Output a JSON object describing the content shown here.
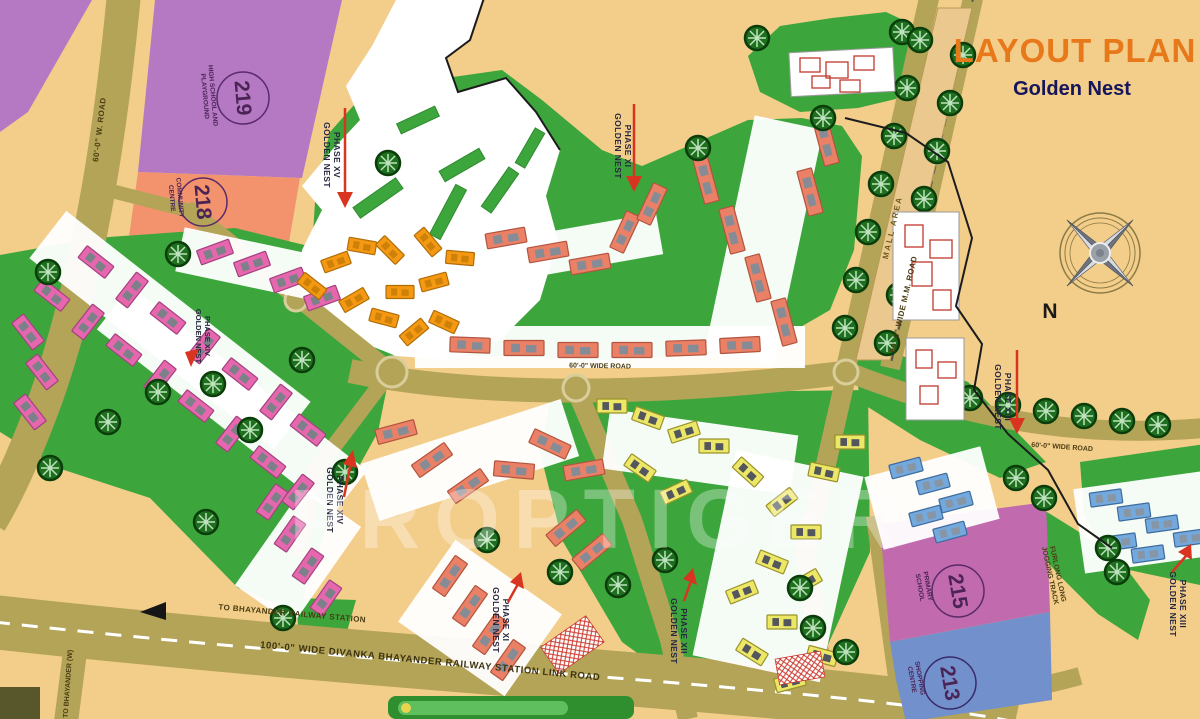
{
  "title": {
    "main": "LAYOUT PLAN",
    "subtitle": "Golden Nest"
  },
  "compass": {
    "north_label": "N"
  },
  "watermark": "PROPTIGER",
  "parcels": [
    {
      "number": "219",
      "label_line1": "HIGH SCHOOL AND",
      "label_line2": "PLAYGROUND"
    },
    {
      "number": "218",
      "label_line1": "COMMUNITY",
      "label_line2": "CENTRE"
    },
    {
      "number": "215",
      "label_line1": "PRIMARY",
      "label_line2": "SCHOOL"
    },
    {
      "number": "213",
      "label_line1": "SHOPPING",
      "label_line2": "CENTRE"
    }
  ],
  "phase_markers": [
    {
      "name": "GOLDEN NEST",
      "phase": "PHASE XV"
    },
    {
      "name": "GOLDEN NEST",
      "phase": "PHASE XI"
    },
    {
      "name": "GOLDEN NEST",
      "phase": "PHASE XIII"
    },
    {
      "name": "GOLDEN NEST",
      "phase": "PHASE XIV"
    },
    {
      "name": "GOLDEN NEST",
      "phase": "PHASE XIV"
    },
    {
      "name": "GOLDEN NEST",
      "phase": "PHASE XI"
    },
    {
      "name": "GOLDEN NEST",
      "phase": "PHASE XII"
    },
    {
      "name": "GOLDEN NEST",
      "phase": "PHASE XIII"
    }
  ],
  "roads": {
    "main_link_road": "100'-0\" WIDE DIVANKA BHAYANDER RAILWAY STATION LINK ROAD",
    "to_station": "TO BHAYANDER RAILWAY STATION",
    "to_bhayander_w": "TO BHAYANDER (W)",
    "west_road": "60'-0\" W. ROAD",
    "mm_road": "90'-0\" WIDE M.M. ROAD",
    "mall_strip": "MALL AREA",
    "internal_road": "60'-0\" WIDE ROAD"
  },
  "features": {
    "jogging_track_line1": "FURLONG LONG",
    "jogging_track_line2": "JOGGING TRACK"
  },
  "colors": {
    "background": "#F3CD8A",
    "road": "#B3A458",
    "green": "#3CA63C",
    "title_orange": "#E8791B",
    "navy": "#15155B",
    "arrow_red": "#D8341F",
    "parcel_219": "#B579C4",
    "parcel_218": "#F2936D",
    "parcel_215": "#C26AAE",
    "parcel_213": "#7290CC",
    "bldg_pink": "#E767AE",
    "bldg_orange": "#F59812",
    "bldg_salmon": "#EA8166",
    "bldg_yellow": "#EDE768",
    "bldg_blue": "#74A9DE"
  }
}
